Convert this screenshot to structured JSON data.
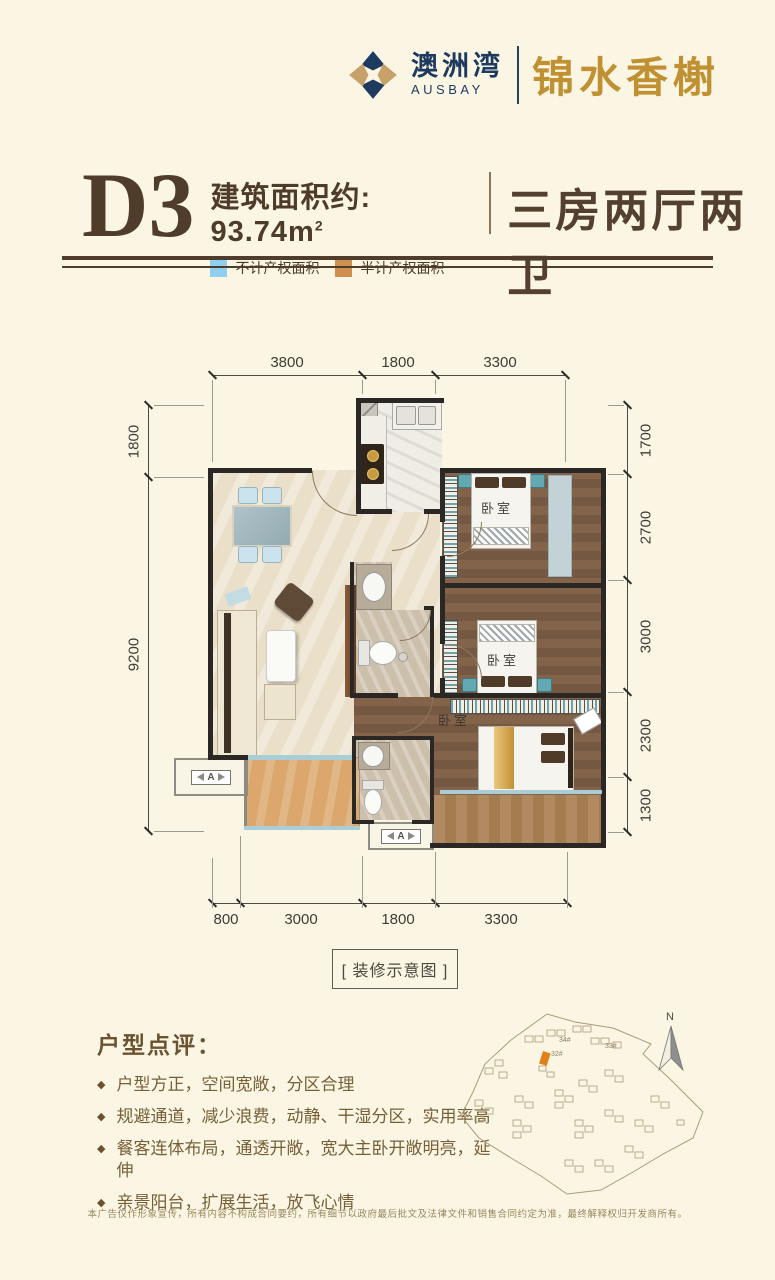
{
  "page": {
    "background": "#FBF6E3"
  },
  "header": {
    "brand_cn": "澳洲湾",
    "brand_en": "AUSBAY",
    "project_name": "锦水香榭",
    "brand_navy": "#1E3A5F",
    "brand_gold": "#C09132"
  },
  "title": {
    "unit": "D3",
    "area_label": "建筑面积约: 93.74m",
    "area_sup": "2",
    "layout": "三房两厅两卫",
    "legend": [
      {
        "label": "不计产权面积",
        "color": "#8FCFF0"
      },
      {
        "label": "半计产权面积",
        "color": "#CE8F4F"
      }
    ]
  },
  "floorplan": {
    "caption": "[ 装修示意图 ]",
    "bedroom_label": "卧室",
    "ac_label": "A",
    "dims": {
      "top": [
        "3800",
        "1800",
        "3300"
      ],
      "left": [
        "1800",
        "9200"
      ],
      "right": [
        "1700",
        "2700",
        "3000",
        "2300",
        "1300"
      ],
      "bottom": [
        "800",
        "3000",
        "1800",
        "3300"
      ]
    }
  },
  "review": {
    "heading": "户型点评：",
    "bullets": [
      "户型方正，空间宽敞，分区合理",
      "规避通道，减少浪费，动静、干湿分区，实用率高",
      "餐客连体布局，通透开敞，宽大主卧开敞明亮，延伸",
      "亲景阳台，扩展生活，放飞心情"
    ]
  },
  "sitemap": {
    "north_label": "N",
    "labels": [
      "34#",
      "32#",
      "33#"
    ],
    "highlight_color": "#E2801A"
  },
  "footer": {
    "disclaimer": "本广告仅作形象宣传，所有内容不构成合同要约，所有细节以政府最后批文及法律文件和销售合同约定为准，最终解释权归开发商所有。"
  }
}
